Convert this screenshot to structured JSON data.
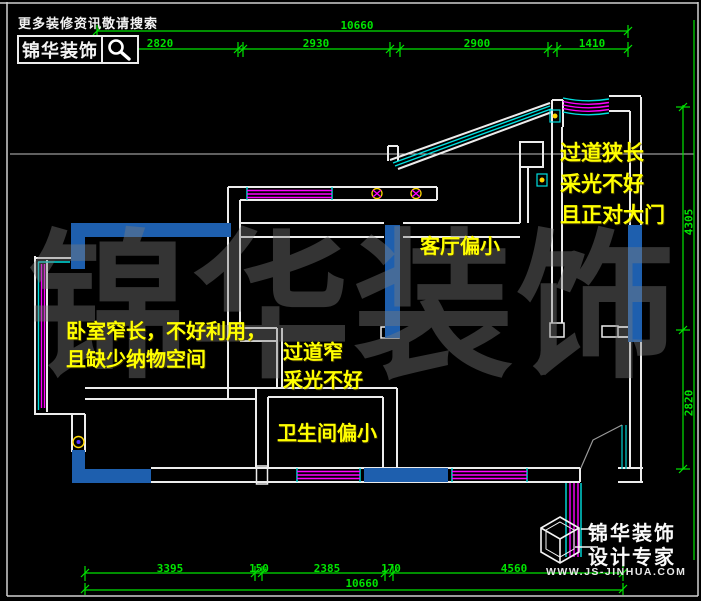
{
  "header": {
    "search_hint": "更多装修资讯敬请搜索",
    "brand": "锦华装饰"
  },
  "watermark": {
    "char1": "锦",
    "char2": "华",
    "char3": "装",
    "char4": "饰"
  },
  "annotations": {
    "bedroom": {
      "line1": "卧室窄长，不好利用，",
      "line2": "且缺少纳物空间"
    },
    "corridor": {
      "line1": "过道窄",
      "line2": "采光不好"
    },
    "bathroom": {
      "line1": "卫生间偏小"
    },
    "living": {
      "line1": "客厅偏小"
    },
    "entry_hall": {
      "line1": "过道狭长",
      "line2": "采光不好",
      "line3": "且正对大门"
    }
  },
  "dimensions": {
    "top": {
      "overall": "10660",
      "segments": [
        "2820",
        "2930",
        "2900",
        "1410"
      ]
    },
    "bottom": {
      "overall": "10660",
      "segments": [
        "3395",
        "150",
        "2385",
        "170",
        "4560"
      ]
    },
    "right": {
      "segments": [
        "4305",
        "2820"
      ]
    }
  },
  "footer_logo": {
    "brand": "锦华装饰",
    "tagline": "设计专家",
    "url": "WWW.JS-JINHUA.COM"
  },
  "colors": {
    "dimension_green": "#00e400",
    "annotation_yellow": "#ffff00",
    "wall_white": "#ececec",
    "highlight_blue": "#1e5fae",
    "window_magenta": "#ff00ff",
    "window_cyan": "#00e0e0",
    "door_teal": "#00a8a8"
  }
}
